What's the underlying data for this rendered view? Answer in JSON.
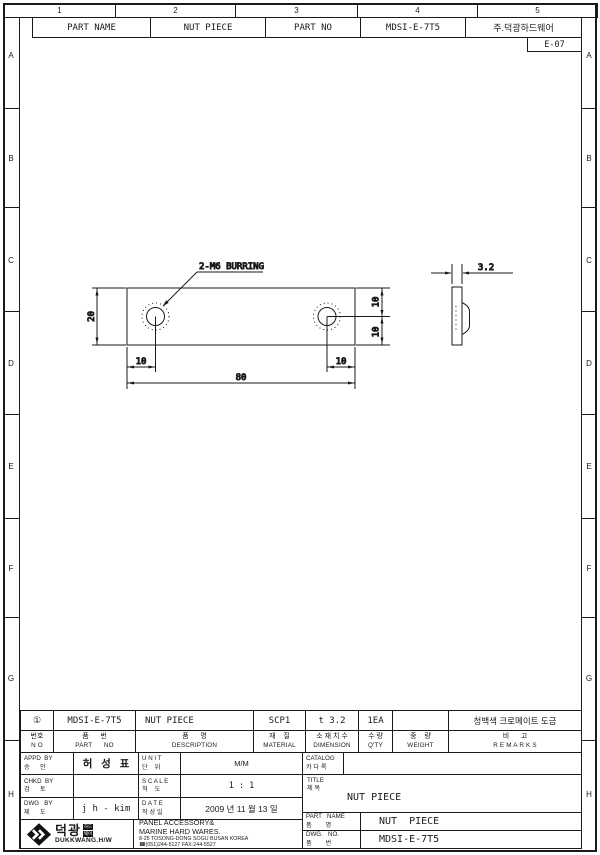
{
  "sheet": {
    "zone_numbers": [
      "1",
      "2",
      "3",
      "4",
      "5"
    ],
    "zone_letters": [
      "A",
      "B",
      "C",
      "D",
      "E",
      "F",
      "G",
      "H"
    ],
    "doc_code": "E-07"
  },
  "header": {
    "part_name_label": "PART NAME",
    "part_name_value": "NUT PIECE",
    "part_no_label": "PART NO",
    "part_no_value": "MDSI-E-7T5",
    "company": "주.덕광하드웨어"
  },
  "drawing": {
    "burring_label": "2-M6 BURRING",
    "dims": {
      "length": "80",
      "height": "20",
      "hole_left": "10",
      "hole_right": "10",
      "hole_top": "10",
      "hole_bottom": "10",
      "thickness": "3.2"
    }
  },
  "titleblock": {
    "row1": {
      "no": "①",
      "part_no": "MDSI-E-7T5",
      "description": "NUT PIECE",
      "material": "SCP1",
      "dimension": "t 3.2",
      "qty": "1EA",
      "weight": "",
      "remarks": "청백색 크로메이트 도금"
    },
    "headers": [
      {
        "ko": "번호",
        "en": "N O"
      },
      {
        "ko": "품      번",
        "en": "PART      NO"
      },
      {
        "ko": "품      명",
        "en": "DESCRIPTION"
      },
      {
        "ko": "재    질",
        "en": "MATERIAL"
      },
      {
        "ko": "소 재 치 수",
        "en": "DIMENSION"
      },
      {
        "ko": "수 량",
        "en": "Q'TY"
      },
      {
        "ko": "중    량",
        "en": "WEIGHT"
      },
      {
        "ko": "비      고",
        "en": "R E M A R K S"
      }
    ],
    "appd": {
      "en": "APPD  BY",
      "ko": "승      인",
      "value": "허   성   표"
    },
    "chkd": {
      "en": "CHKD  BY",
      "ko": "검      토",
      "value": ""
    },
    "dwgby": {
      "en": "DWG   BY",
      "ko": "제      도",
      "value": "j h - kim"
    },
    "unit": {
      "en": "U N I T",
      "ko": "단    위",
      "value": "M/M"
    },
    "scale": {
      "en": "S C A L E",
      "ko": "척    도",
      "value": "1 : 1"
    },
    "date": {
      "en": "D A T E",
      "ko": "작 성 일",
      "value": "2009 년 11 월 13 일"
    },
    "catalog": {
      "en": "CATALOG",
      "ko": "카 다 록",
      "value": ""
    },
    "title": {
      "en": "TITLE",
      "ko": "제 목",
      "value": "NUT PIECE"
    },
    "part_name": {
      "en": "PART   NAME",
      "ko": "품        명",
      "value": "NUT  PIECE"
    },
    "dwg_no": {
      "en": "DWG.   NO.",
      "ko": "품        번",
      "value": "MDSI-E-7T5"
    },
    "company": {
      "logo_ko": "덕광",
      "badge_top": "하드",
      "badge_bottom": "웨어",
      "logo_en": "DUKKWANG.H/W",
      "line1": "PANEL ACCESSORY&",
      "line2": "MARINE HARD WARES.",
      "line3": "8-25 TOSONG-DONG SOGU BUSAN KOREA",
      "line4": "☎(051)244-5127 FAX:244-5527"
    }
  }
}
